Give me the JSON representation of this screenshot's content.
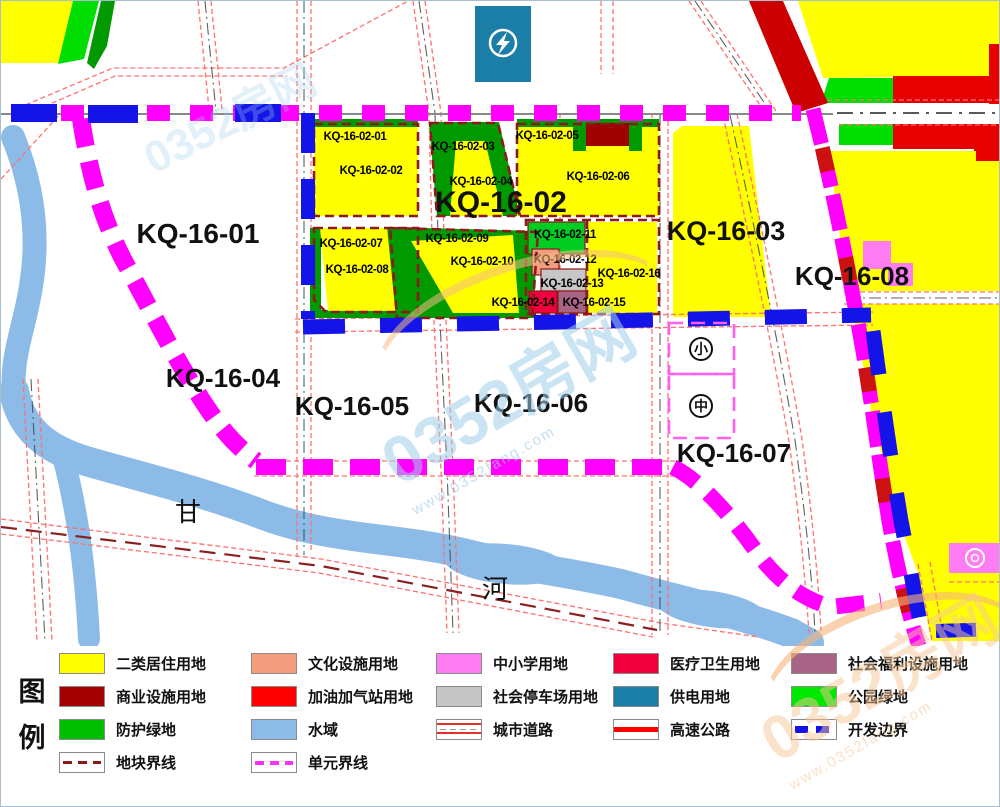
{
  "map": {
    "blocks": {
      "kq_16_01": "KQ-16-01",
      "kq_16_02": "KQ-16-02",
      "kq_16_03": "KQ-16-03",
      "kq_16_04": "KQ-16-04",
      "kq_16_05": "KQ-16-05",
      "kq_16_06": "KQ-16-06",
      "kq_16_07": "KQ-16-07",
      "kq_16_08": "KQ-16-08"
    },
    "subparcels": {
      "p01": "KQ-16-02-01",
      "p02": "KQ-16-02-02",
      "p03": "KQ-16-02-03",
      "p04": "KQ-16-02-04",
      "p05": "KQ-16-02-05",
      "p06": "KQ-16-02-06",
      "p07": "KQ-16-02-07",
      "p08": "KQ-16-02-08",
      "p09": "KQ-16-02-09",
      "p10": "KQ-16-02-10",
      "p11": "KQ-16-02-11",
      "p12": "KQ-16-02-12",
      "p13": "KQ-16-02-13",
      "p14": "KQ-16-02-14",
      "p15": "KQ-16-02-15",
      "p16": "KQ-16-02-16"
    },
    "river_name_chars": {
      "first": "甘",
      "second": "河"
    },
    "school_markers": {
      "elementary": "小",
      "middle": "中"
    }
  },
  "legend": {
    "title_chars": {
      "first": "图",
      "second": "例"
    },
    "items": [
      {
        "label": "二类居住用地",
        "color": "#FFFF00"
      },
      {
        "label": "文化设施用地",
        "color": "#F49C7E"
      },
      {
        "label": "中小学用地",
        "color": "#FF7DF2"
      },
      {
        "label": "医疗卫生用地",
        "color": "#F0003C"
      },
      {
        "label": "社会福利设施用地",
        "color": "#A86484"
      },
      {
        "label": "商业设施用地",
        "color": "#A50000"
      },
      {
        "label": "加油加气站用地",
        "color": "#FF0000"
      },
      {
        "label": "社会停车场用地",
        "color": "#C6C6C6"
      },
      {
        "label": "供电用地",
        "color": "#1B7EA6"
      },
      {
        "label": "公园绿地",
        "color": "#00E800"
      },
      {
        "label": "防护绿地",
        "color": "#00BE00"
      },
      {
        "label": "水域",
        "color": "#8CBBE8"
      },
      {
        "label": "城市道路",
        "symbol": "urban-road"
      },
      {
        "label": "高速公路",
        "symbol": "highway",
        "color": "#FF0000"
      },
      {
        "label": "开发边界",
        "symbol": "development-boundary",
        "color": "#1414E8"
      },
      {
        "label": "地块界线",
        "symbol": "parcel-boundary",
        "color": "#8B1A1A"
      },
      {
        "label": "单元界线",
        "symbol": "unit-boundary",
        "color": "#FF30FF"
      }
    ]
  },
  "watermark": {
    "text": "0352房网",
    "url": "www.0352fang.com"
  },
  "colors": {
    "unit_boundary": "#FF00FF",
    "development_boundary": "#1414E8",
    "parcel_boundary": "#8B1A1A",
    "road_edge": "#FF7070",
    "highway": "#CC0000",
    "water": "#8CBBE8",
    "protective_green": "#009A00"
  }
}
